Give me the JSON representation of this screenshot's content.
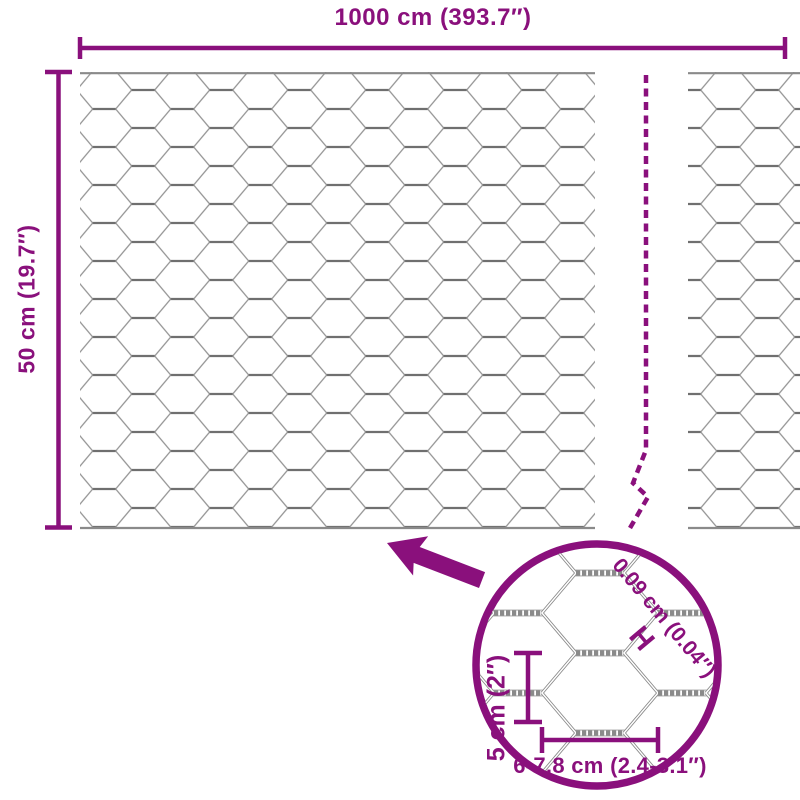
{
  "diagram": {
    "accent_color": "#8A107C",
    "wire_color": "#8a8a8a",
    "top_dimension": {
      "label": "1000 cm (393.7″)"
    },
    "left_dimension": {
      "label": "50 cm (19.7″)"
    },
    "detail": {
      "wire_diameter_label": "0.09 cm (0.04″)",
      "wire_diameter_symbol": "H",
      "cell_height_label": "5 cm (2″)",
      "cell_width_label": "6-7,8 cm (2.4-3.1″)"
    }
  }
}
